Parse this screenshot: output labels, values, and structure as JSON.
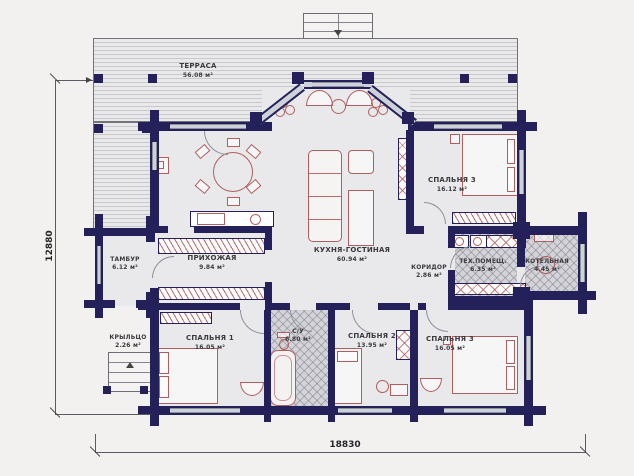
{
  "plan": {
    "terrace": {
      "name": "ТЕРРАСА",
      "area": "56.08 м²"
    },
    "rooms": [
      {
        "name": "ТАМБУР",
        "area": "6.12 м²"
      },
      {
        "name": "ПРИХОЖАЯ",
        "area": "9.84 м²"
      },
      {
        "name": "КУХНЯ-ГОСТИНАЯ",
        "area": "60.94 м²"
      },
      {
        "name": "СПАЛЬНЯ 3",
        "area": "16.12 м²"
      },
      {
        "name": "КОРИДОР",
        "area": "2.86 м²"
      },
      {
        "name": "ТЕХ.ПОМЕЩ.",
        "area": "6.35 м²"
      },
      {
        "name": "КОТЕЛЬНАЯ",
        "area": "4.45 м²"
      },
      {
        "name": "КРЫЛЬЦО",
        "area": "2.26 м²"
      },
      {
        "name": "СПАЛЬНЯ 1",
        "area": "16.05 м²"
      },
      {
        "name": "С/У",
        "area": "6.80 м²"
      },
      {
        "name": "СПАЛЬНЯ 2",
        "area": "13.95 м²"
      },
      {
        "name": "СПАЛЬНЯ 3",
        "area": "16.05 м²"
      }
    ],
    "dimensions": {
      "left": "12880",
      "bottom": "18830"
    },
    "colors": {
      "wall": "#23205a",
      "furniture": "#b05e5e",
      "deck": "#c9c9cd"
    }
  }
}
